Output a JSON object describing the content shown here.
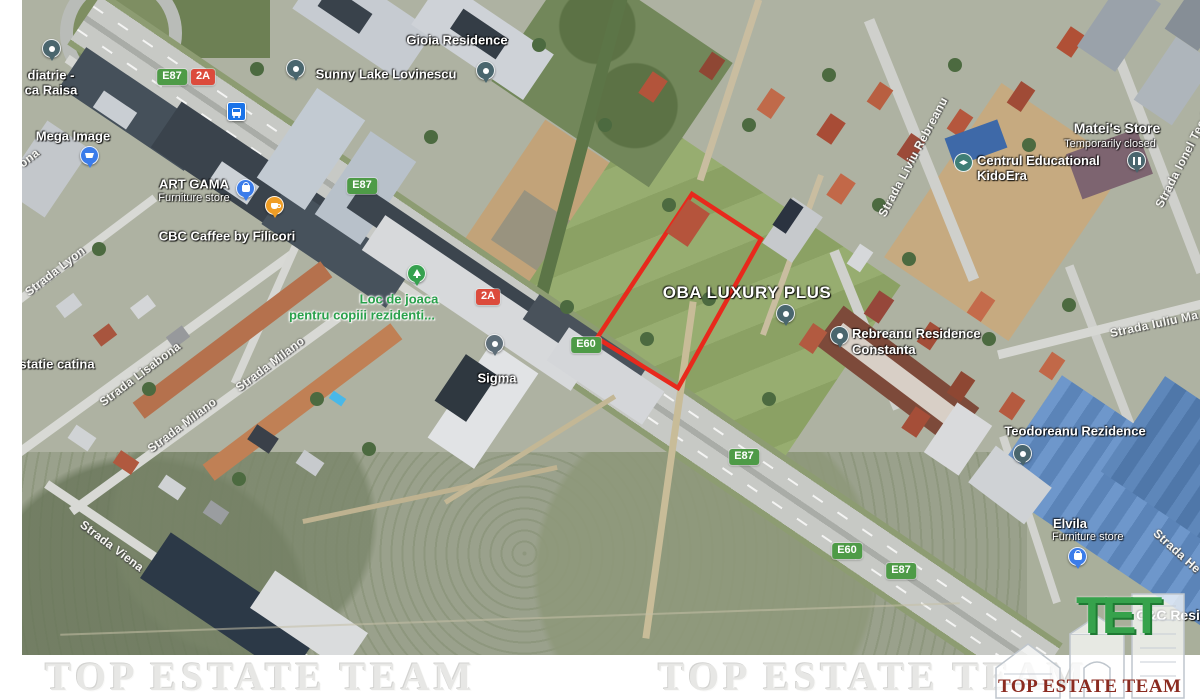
{
  "branding": {
    "strip_watermark": "TOP ESTATE TEAM",
    "logo": {
      "monogram": "TET",
      "name": "TOP ESTATE TEAM"
    }
  },
  "colors": {
    "parcel_outline": "#e8291c",
    "badge_green": "#4e9b47",
    "badge_red": "#dc4b3c",
    "pin_teal": "#4a666e",
    "pin_blue": "#3b7cea",
    "pin_orange": "#ef9d25",
    "pin_green": "#36a14f",
    "pin_slate": "#5d6d78",
    "logo_green": "#36a24c",
    "logo_maroon": "#8b2b20"
  },
  "icons": {
    "pins": [
      "dot",
      "cart",
      "bag",
      "coffee-cup",
      "tree",
      "pause",
      "graduation-cap"
    ],
    "transit": "bus-stop"
  },
  "map": {
    "road_badges": [
      {
        "text": "E87",
        "type": "green"
      },
      {
        "text": "2A",
        "type": "red"
      },
      {
        "text": "E87",
        "type": "green"
      },
      {
        "text": "2A",
        "type": "red"
      },
      {
        "text": "E60",
        "type": "green"
      },
      {
        "text": "E87",
        "type": "green"
      },
      {
        "text": "E60",
        "type": "green"
      },
      {
        "text": "E87",
        "type": "green"
      }
    ],
    "street_labels": [
      {
        "text": "ona"
      },
      {
        "text": "Strada Lyon"
      },
      {
        "text": "Strada Lisabona"
      },
      {
        "text": "Strada Milano"
      },
      {
        "text": "Strada Milano"
      },
      {
        "text": "Strada Viena"
      },
      {
        "text": "Strada Liviu Rebreanu"
      },
      {
        "text": "Strada Ionel Teode"
      },
      {
        "text": "Strada Iuliu Ma"
      },
      {
        "text": "Strada He"
      }
    ],
    "places": [
      {
        "id": "pediatrie",
        "lines": [
          "diatrie -",
          "ca Raisa"
        ]
      },
      {
        "id": "mega-image",
        "lines": [
          "Mega Image"
        ],
        "pin": "cart"
      },
      {
        "id": "art-gama",
        "lines": [
          "ART GAMA",
          "Furniture store"
        ],
        "pin": "bag"
      },
      {
        "id": "cbc-caffee",
        "lines": [
          "CBC Caffee by Filicori"
        ],
        "pin": "coffee-cup"
      },
      {
        "id": "sunny-lake",
        "lines": [
          "Sunny Lake Lovinescu"
        ],
        "pin": "dot"
      },
      {
        "id": "gioia",
        "lines": [
          "Gioia Residence"
        ],
        "pin": "dot"
      },
      {
        "id": "loc-de-joaca",
        "lines": [
          "Loc de joaca",
          "pentru copiii rezidenti..."
        ],
        "pin": "tree"
      },
      {
        "id": "sigma",
        "lines": [
          "Sigma"
        ],
        "pin": "dot"
      },
      {
        "id": "oba-luxury",
        "lines": [
          "OBA LUXURY PLUS"
        ],
        "pin": "dot"
      },
      {
        "id": "mateis-store",
        "lines": [
          "Matei's Store",
          "Temporarily closed"
        ],
        "pin": "pause"
      },
      {
        "id": "kidoera",
        "lines": [
          "Centrul Educational",
          "KidoEra"
        ],
        "pin": "graduation-cap"
      },
      {
        "id": "rebreanu",
        "lines": [
          "Rebreanu Residence",
          "Constanta"
        ],
        "pin": "dot"
      },
      {
        "id": "teodoreanu",
        "lines": [
          "Teodoreanu Rezidence"
        ],
        "pin": "dot"
      },
      {
        "id": "elvila",
        "lines": [
          "Elvila",
          "Furniture store"
        ],
        "pin": "bag"
      },
      {
        "id": "cc-residence",
        "lines": [
          "C&C Resi"
        ]
      },
      {
        "id": "statie-catina",
        "lines": [
          "statie catina"
        ]
      }
    ],
    "parcel_outline": {
      "color": "#e8291c",
      "points": "692,194 761,239 678,388 597,338"
    }
  }
}
